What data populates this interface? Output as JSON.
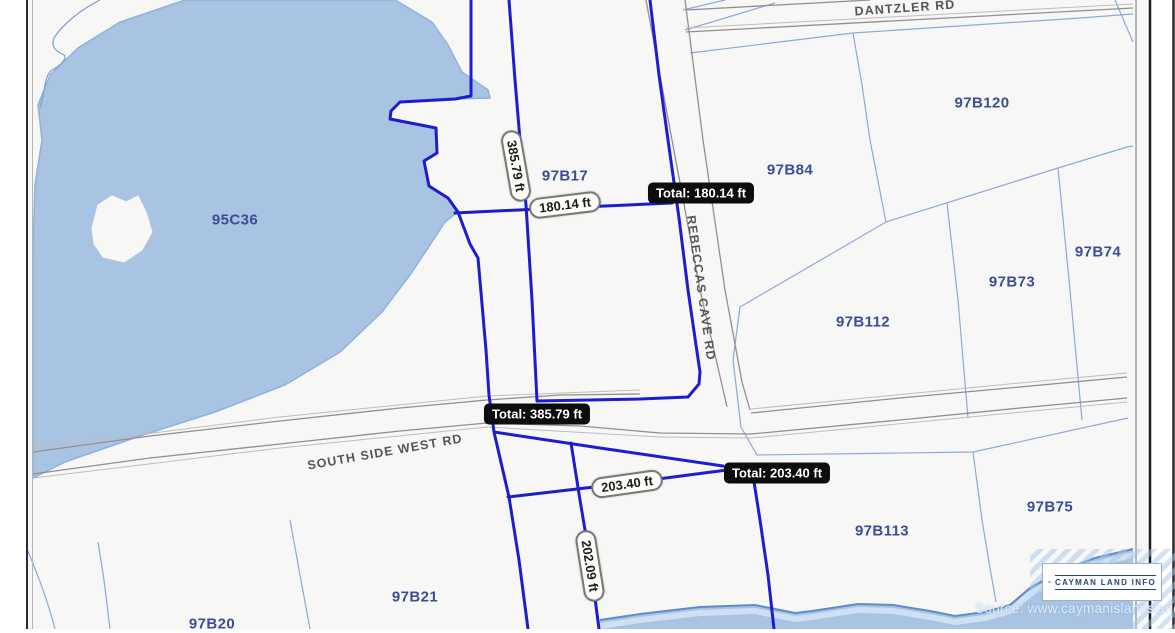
{
  "map": {
    "parcel_labels": [
      {
        "text": "95C36",
        "x": 235,
        "y": 220,
        "rot": 0
      },
      {
        "text": "97B17",
        "x": 565,
        "y": 176,
        "rot": 0
      },
      {
        "text": "97B84",
        "x": 790,
        "y": 170,
        "rot": 0
      },
      {
        "text": "97B120",
        "x": 982,
        "y": 103,
        "rot": 0
      },
      {
        "text": "97B74",
        "x": 1098,
        "y": 252,
        "rot": 0
      },
      {
        "text": "97B73",
        "x": 1012,
        "y": 282,
        "rot": 0
      },
      {
        "text": "97B112",
        "x": 863,
        "y": 322,
        "rot": 0
      },
      {
        "text": "97B113",
        "x": 882,
        "y": 531,
        "rot": 0
      },
      {
        "text": "97B75",
        "x": 1050,
        "y": 507,
        "rot": 0
      },
      {
        "text": "97B21",
        "x": 415,
        "y": 597,
        "rot": 0
      },
      {
        "text": "97B20",
        "x": 212,
        "y": 624,
        "rot": 0
      }
    ],
    "road_labels": [
      {
        "text": "DANTZLER RD",
        "x": 905,
        "y": 8,
        "rot": -4
      },
      {
        "text": "REBECCAS CAVE RD",
        "x": 701,
        "y": 288,
        "rot": 82
      },
      {
        "text": "SOUTH SIDE WEST RD",
        "x": 385,
        "y": 452,
        "rot": -10
      }
    ],
    "measure_pills": [
      {
        "text": "385.79 ft",
        "x": 516,
        "y": 166,
        "rot": 80
      },
      {
        "text": "180.14 ft",
        "x": 565,
        "y": 205,
        "rot": -7
      },
      {
        "text": "203.40 ft",
        "x": 627,
        "y": 484,
        "rot": -8
      },
      {
        "text": "202.09 ft",
        "x": 590,
        "y": 566,
        "rot": 81
      }
    ],
    "total_badges": [
      {
        "text": "Total: 180.14 ft",
        "x": 701,
        "y": 193,
        "rot": 0
      },
      {
        "text": "Total: 385.79 ft",
        "x": 537,
        "y": 414,
        "rot": 0
      },
      {
        "text": "Total: 203.40 ft",
        "x": 777,
        "y": 473,
        "rot": 0
      }
    ]
  },
  "watermark": {
    "logo": "CAYMAN LAND INFO",
    "source": "Source: www.caymanislandsland"
  },
  "colors": {
    "measure_line": "#1d1dd0",
    "water_fill": "#a9c3e2",
    "water_edge": "#5f8cc8",
    "parcel_boundary": "#8fa8dc",
    "parcel_text": "#3d4d94",
    "road_text": "#565656",
    "badge_bg": "#0d0d0d",
    "pill_bg": "#fdfdfa"
  }
}
